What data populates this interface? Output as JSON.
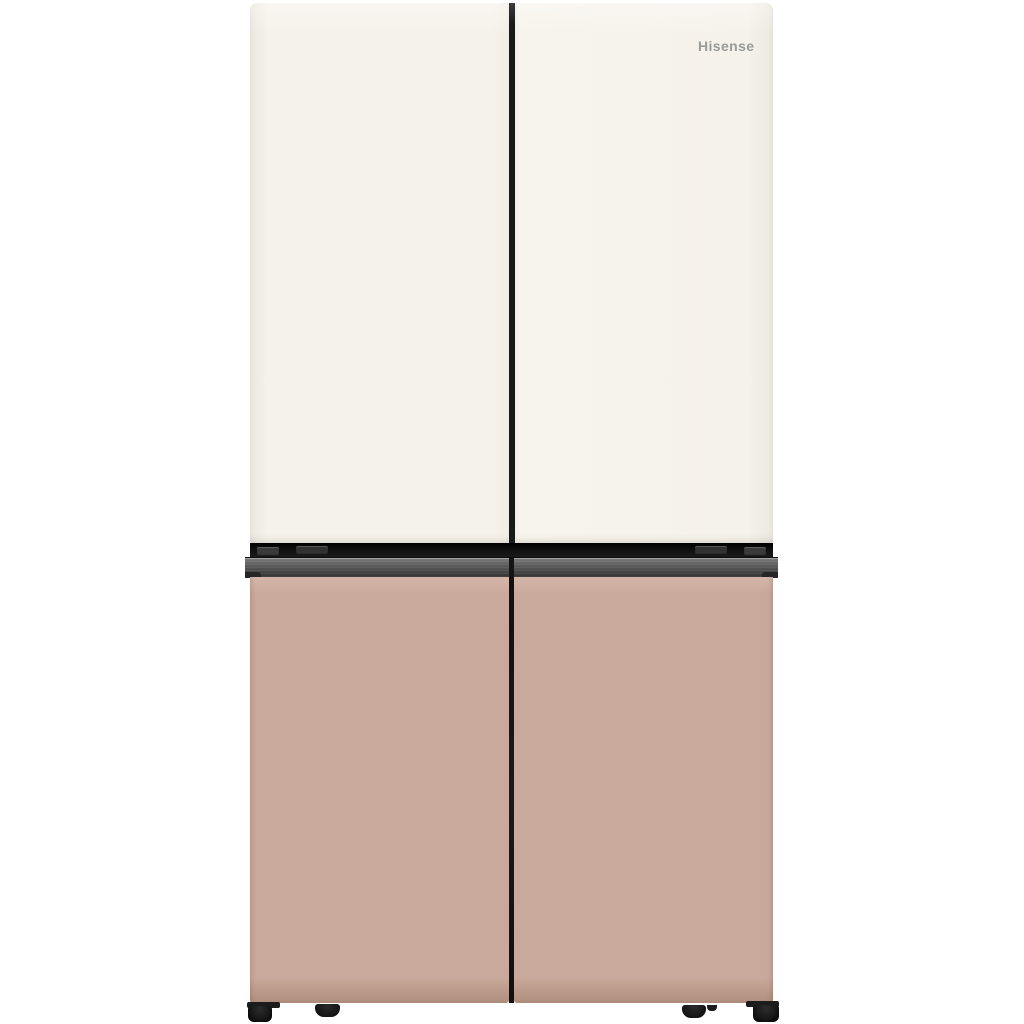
{
  "product": {
    "brand_logo": "Hisense",
    "description": "four-door refrigerator, cream upper doors, clay-pink lower doors, dark metal handle band"
  },
  "colors": {
    "background": "#ffffff",
    "upper_door": "#f5f2ea",
    "upper_door_edge": "#ebe8df",
    "lower_door": "#c9a99b",
    "lower_door_light": "#d6b6a8",
    "lower_door_dark": "#b08e7d",
    "metal_light": "#7d7d7d",
    "metal_dark": "#2f2f2f",
    "groove": "#141414",
    "seam": "#1a1a1a",
    "feet": "#181818",
    "logo_text": "#9a9a9a"
  }
}
